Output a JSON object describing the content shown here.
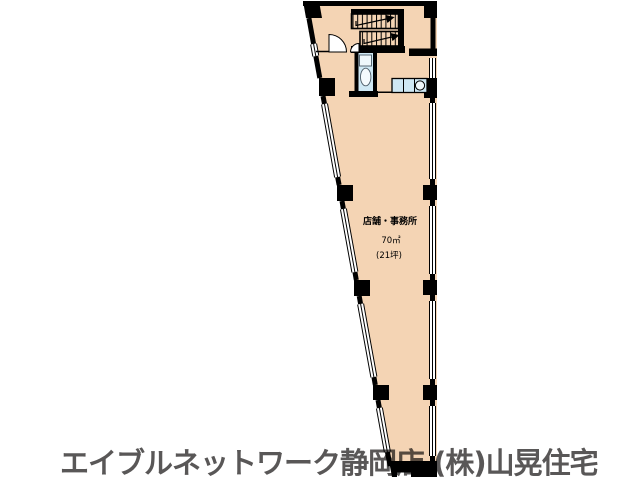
{
  "floor_plan": {
    "room": {
      "label": "店舗・事務所",
      "area_sqm": "70㎡",
      "area_tsubo": "(21坪)"
    },
    "colors": {
      "floor": "#f4d4b4",
      "wall": "#000000",
      "fixture_fill": "#cfe8f4",
      "fixture_light": "#eef7fb",
      "window_fill": "#ffffff"
    },
    "fixtures": [
      "staircase-icon",
      "stair-up-arrow-icon",
      "double-entry-door-icon",
      "toilet-icon",
      "counter-sink-icon",
      "window-icon",
      "pillar-icon"
    ]
  },
  "caption": {
    "text": "エイブルネットワーク静岡店 (株)山晃住宅",
    "color": "#595757"
  }
}
